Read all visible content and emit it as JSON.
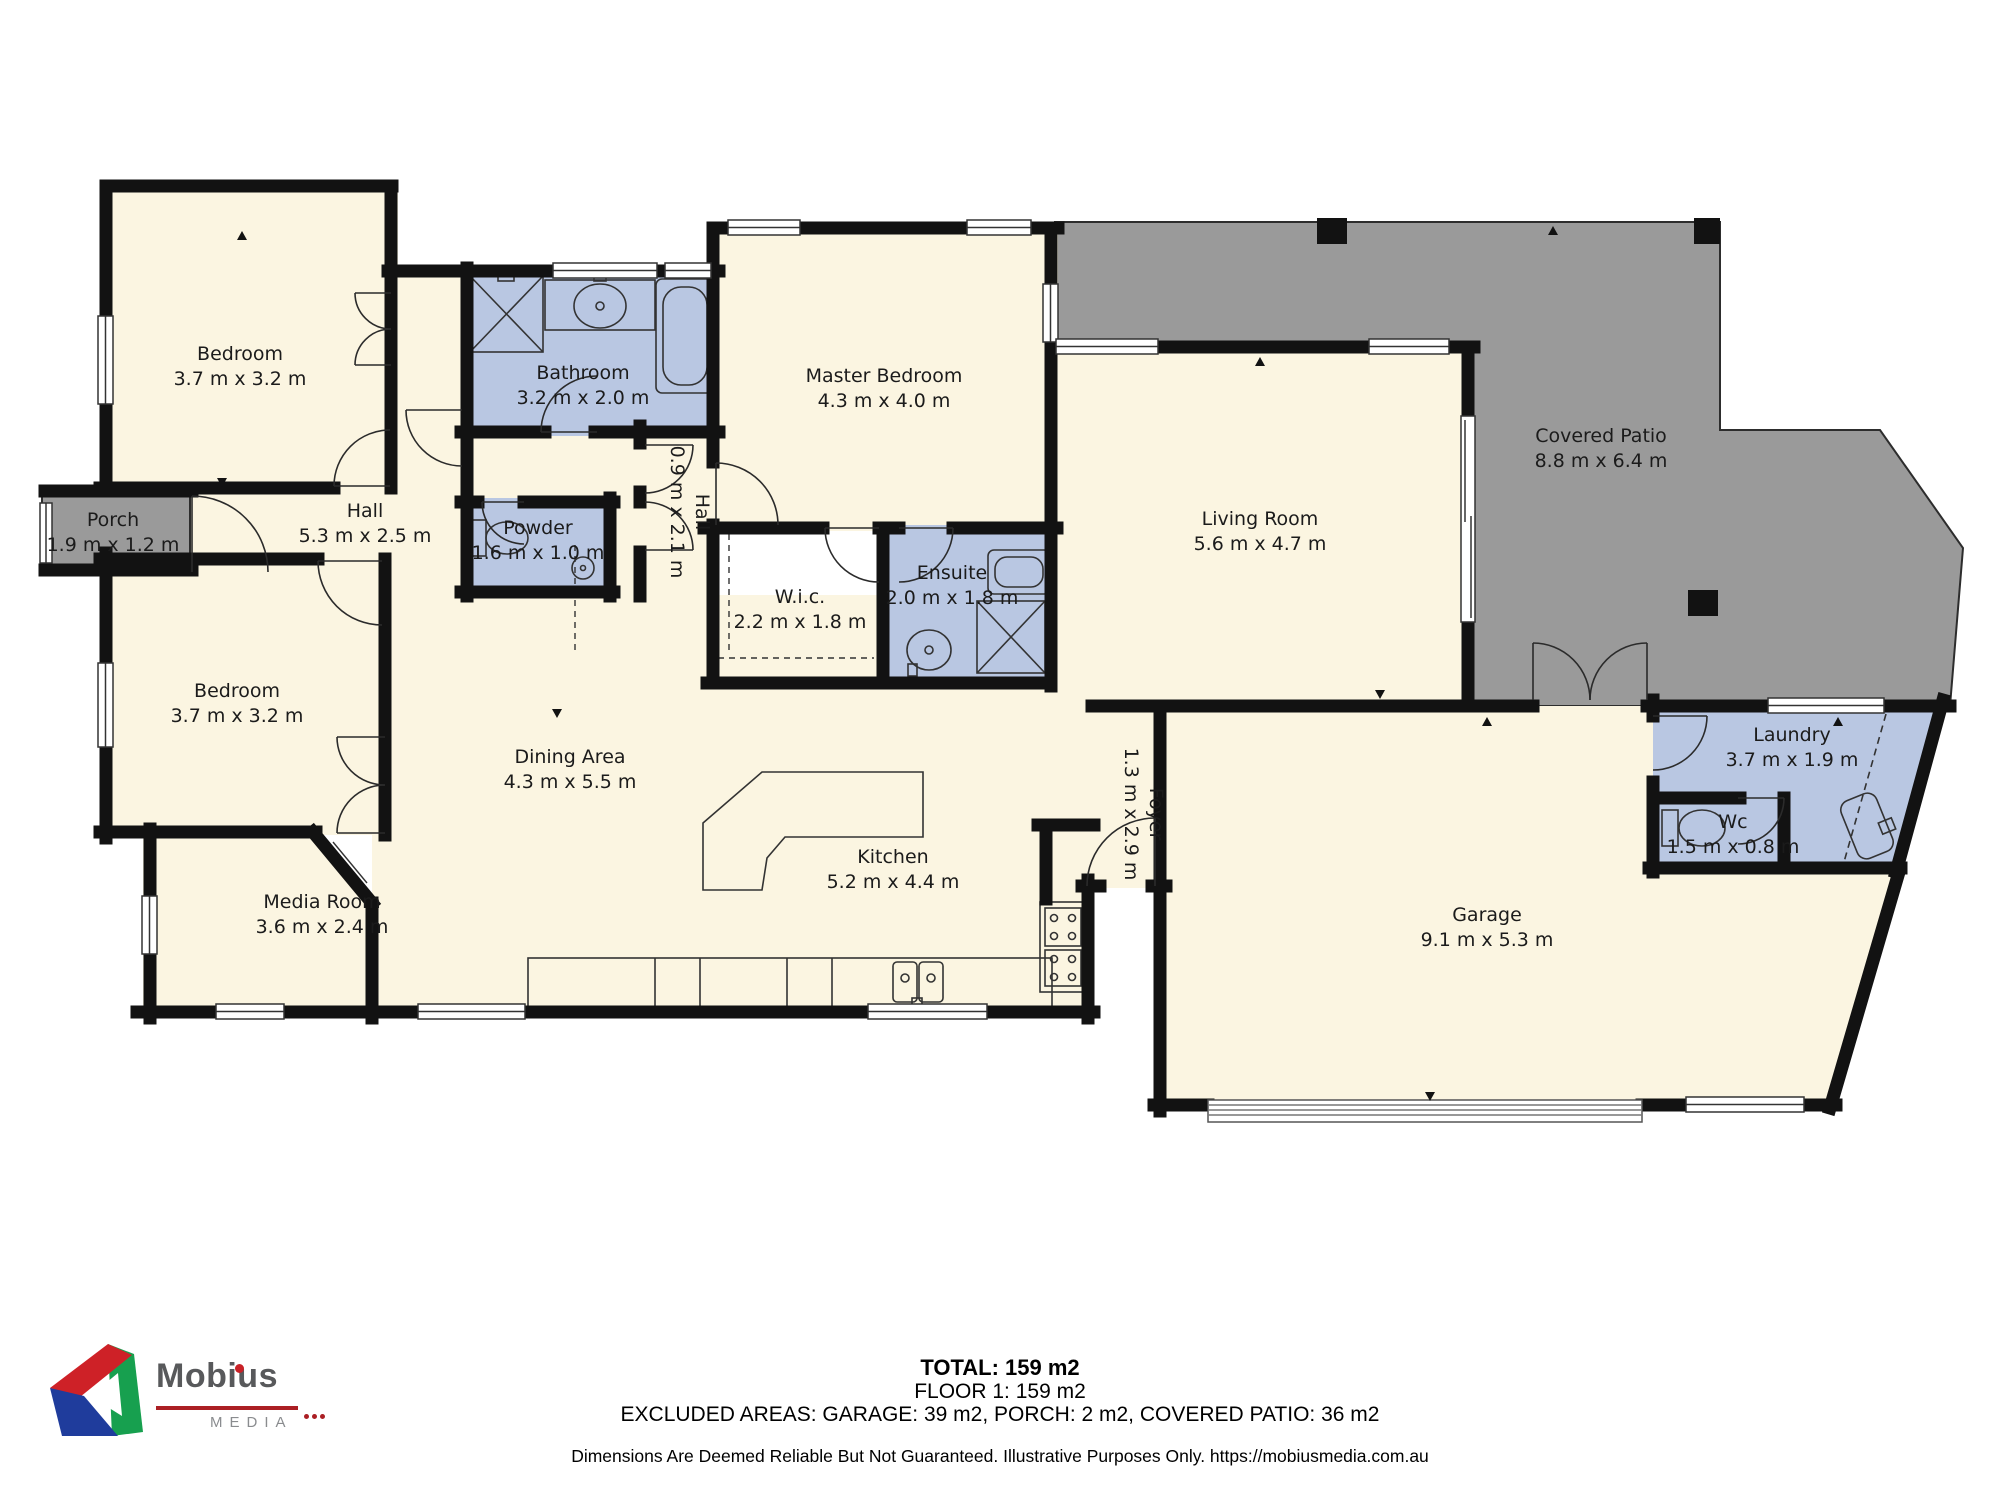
{
  "rooms": {
    "bedroom1": {
      "name": "Bedroom",
      "dims": "3.7 m x 3.2 m"
    },
    "bathroom": {
      "name": "Bathroom",
      "dims": "3.2 m x 2.0 m"
    },
    "master": {
      "name": "Master Bedroom",
      "dims": "4.3 m x 4.0 m"
    },
    "patio": {
      "name": "Covered Patio",
      "dims": "8.8 m x 6.4 m"
    },
    "porch": {
      "name": "Porch",
      "dims": "1.9 m x 1.2 m"
    },
    "hall": {
      "name": "Hall",
      "dims": "5.3 m x 2.5 m"
    },
    "powder": {
      "name": "Powder",
      "dims": "1.6 m x 1.0 m"
    },
    "hall2": {
      "name": "Hall",
      "dims": "0.9 m x 2.1 m"
    },
    "wic": {
      "name": "W.i.c.",
      "dims": "2.2 m x 1.8 m"
    },
    "ensuite": {
      "name": "Ensuite",
      "dims": "2.0 m x 1.8 m"
    },
    "living": {
      "name": "Living Room",
      "dims": "5.6 m x 4.7 m"
    },
    "bedroom2": {
      "name": "Bedroom",
      "dims": "3.7 m x 3.2 m"
    },
    "dining": {
      "name": "Dining Area",
      "dims": "4.3 m x 5.5 m"
    },
    "media": {
      "name": "Media Room",
      "dims": "3.6 m x 2.4 m"
    },
    "kitchen": {
      "name": "Kitchen",
      "dims": "5.2 m x 4.4 m"
    },
    "foyer": {
      "name": "Foyer",
      "dims": "1.3 m x 2.9 m"
    },
    "garage": {
      "name": "Garage",
      "dims": "9.1 m x 5.3 m"
    },
    "laundry": {
      "name": "Laundry",
      "dims": "3.7 m x 1.9 m"
    },
    "wc": {
      "name": "Wc",
      "dims": "1.5 m x 0.8 m"
    }
  },
  "summary": {
    "total": "TOTAL: 159 m2",
    "floor": "FLOOR 1: 159 m2",
    "excluded": "EXCLUDED AREAS: GARAGE: 39 m2, PORCH: 2 m2, COVERED PATIO: 36 m2",
    "disclaimer": "Dimensions Are Deemed Reliable But Not Guaranteed. Illustrative Purposes Only. https://mobiusmedia.com.au"
  },
  "logo": {
    "brand": "Mobius",
    "sub": "MEDIA"
  },
  "colors": {
    "room_fill": "#FBF5E1",
    "wet_room_fill": "#B9C7E2",
    "patio_fill": "#9A9A9A",
    "wall": "#121212",
    "logo_red": "#C92127",
    "logo_green": "#1F9D55",
    "logo_blue": "#1F3C9C"
  }
}
